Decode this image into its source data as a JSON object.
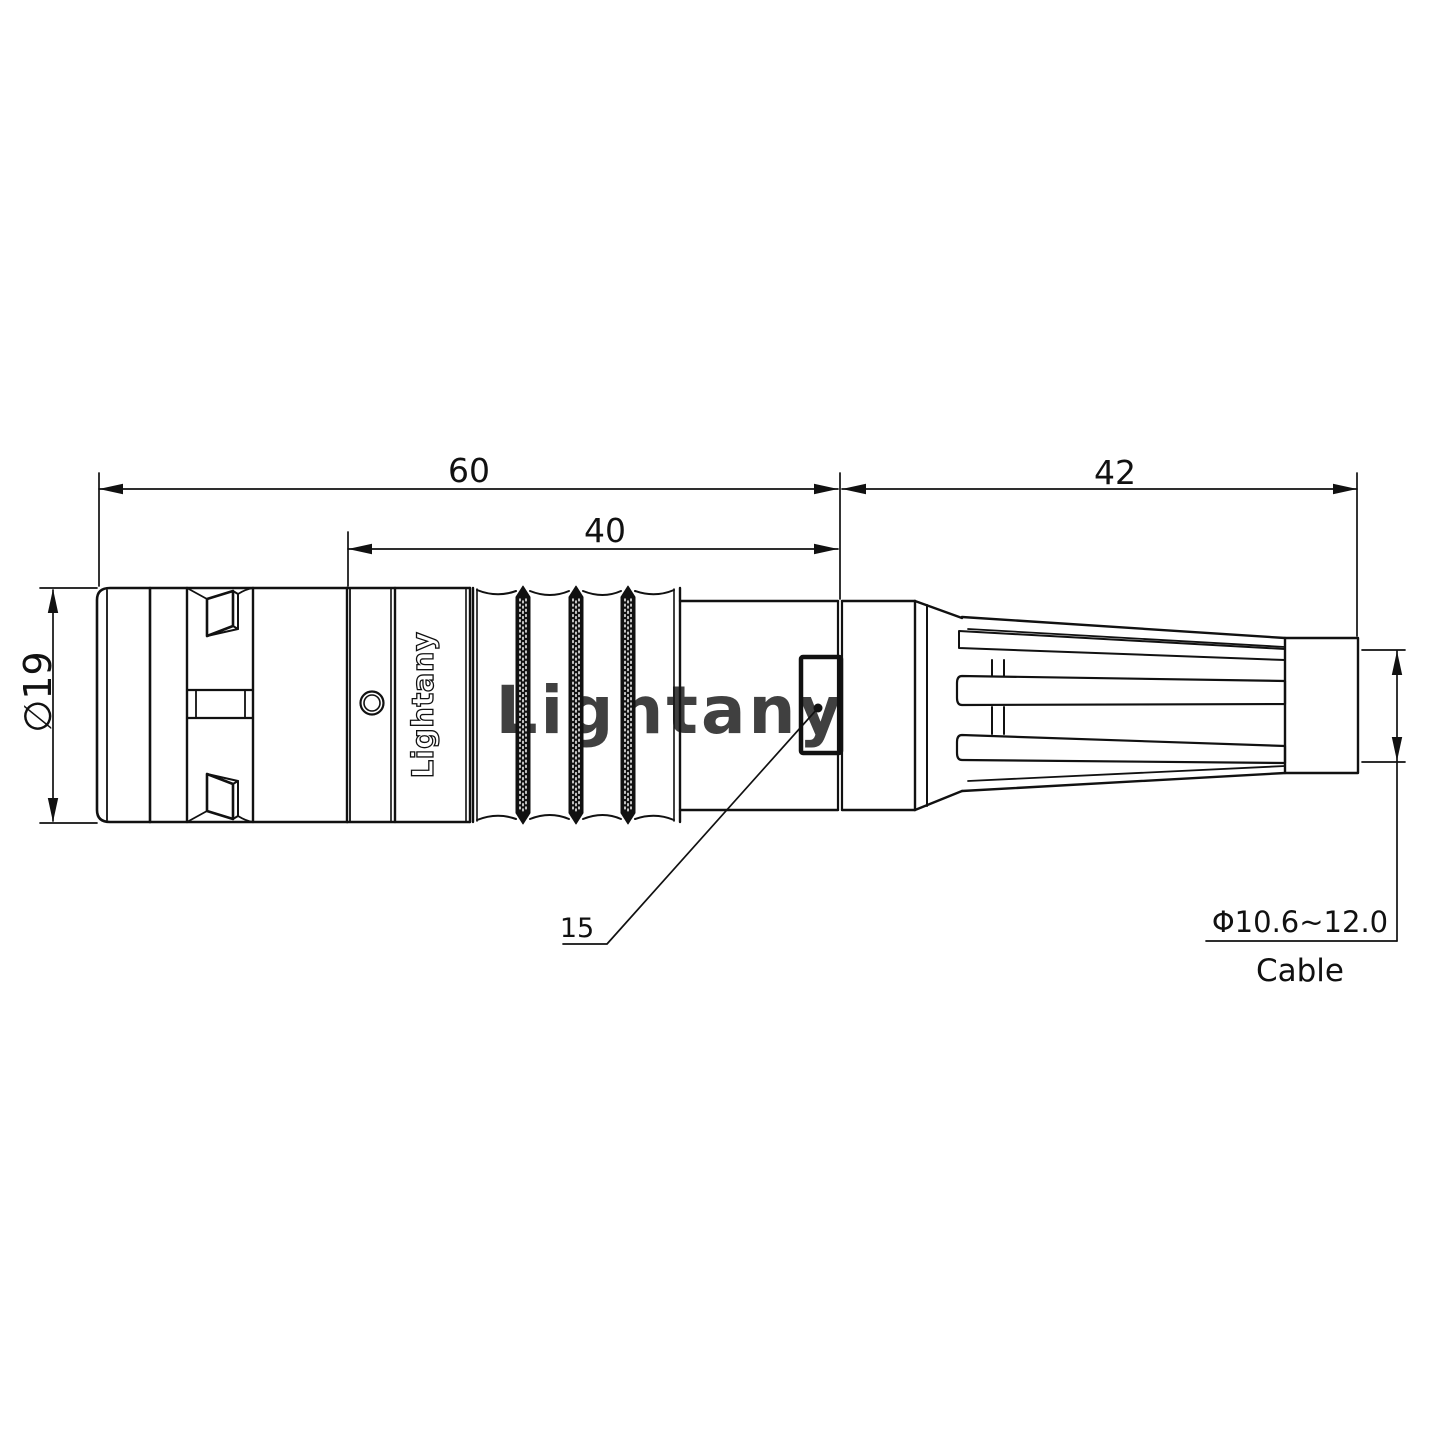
{
  "drawing": {
    "watermark_text": "Lightany",
    "brand_text": "Lightany",
    "dimensions": {
      "overall_length_mm": "60",
      "rear_length_mm": "40",
      "boot_length_mm": "42",
      "body_diameter": "∅19",
      "latch_ref": "15",
      "cable_range": "Φ10.6~12.0",
      "cable_caption": "Cable"
    },
    "colors": {
      "line": "#111111",
      "background": "#ffffff",
      "watermark": "#f6c0c0"
    }
  }
}
